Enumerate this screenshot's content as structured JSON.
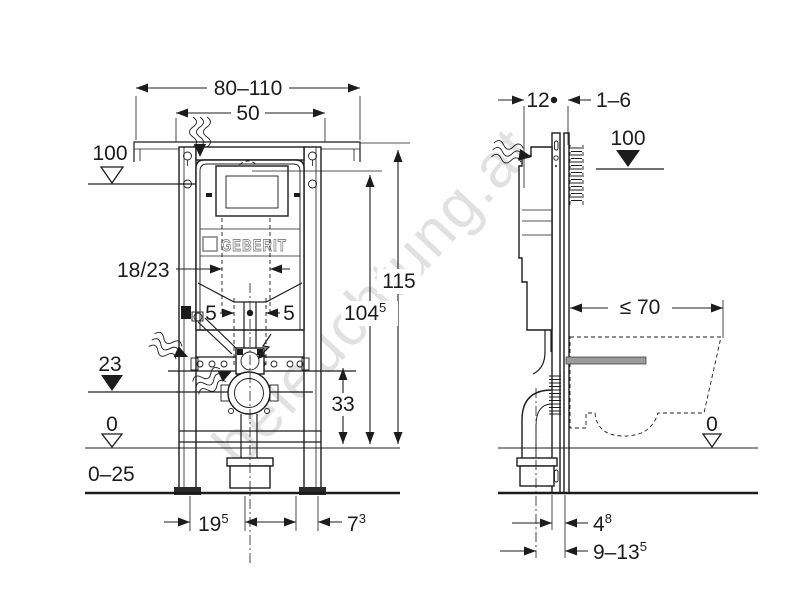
{
  "watermark": "beleuchtung.at",
  "logo": "GEBERIT",
  "front": {
    "rail_width": "80–110",
    "top_width": "50",
    "height_100": "100",
    "opening": "18/23",
    "five_left": "5",
    "five_right": "5",
    "h23": "23",
    "zero": "0",
    "foot_range": "0–25",
    "h115": "115",
    "h104": {
      "main": "104",
      "sup": "5"
    },
    "h33": "33",
    "b19": {
      "main": "19",
      "sup": "5"
    },
    "b7": {
      "main": "7",
      "sup": "3"
    }
  },
  "side": {
    "depth12": "12",
    "wall_finish": "1–6",
    "height_100": "100",
    "pan_depth": "≤ 70",
    "zero": "0",
    "d4": {
      "main": "4",
      "sup": "8"
    },
    "d9": {
      "main": "9–13",
      "sup": "5"
    }
  }
}
